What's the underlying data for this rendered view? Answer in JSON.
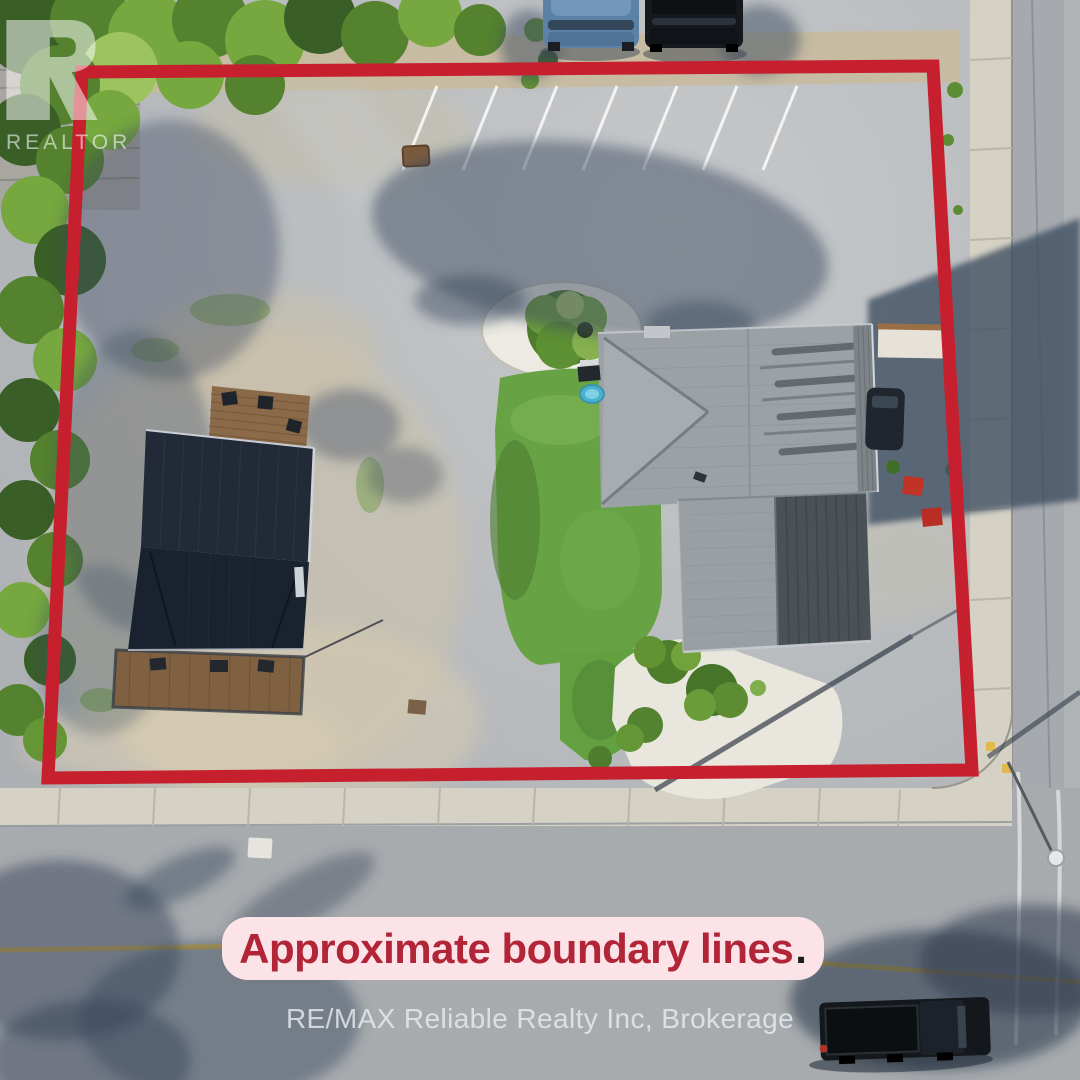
{
  "watermark": {
    "logo_icon": "realtor-r-logo",
    "logo_text": "REALTOR"
  },
  "banner": {
    "text": "Approximate boundary lines",
    "period": "."
  },
  "footer": {
    "brokerage": "RE/MAX Reliable Realty Inc, Brokerage"
  },
  "colors": {
    "boundary_red": "#c6202f",
    "banner_bg": "#fbe3e7",
    "banner_text": "#b22438",
    "banner_period": "#1c1c1c",
    "watermark_white": "#ffffff",
    "brokerage_text": "#e9eef3"
  }
}
